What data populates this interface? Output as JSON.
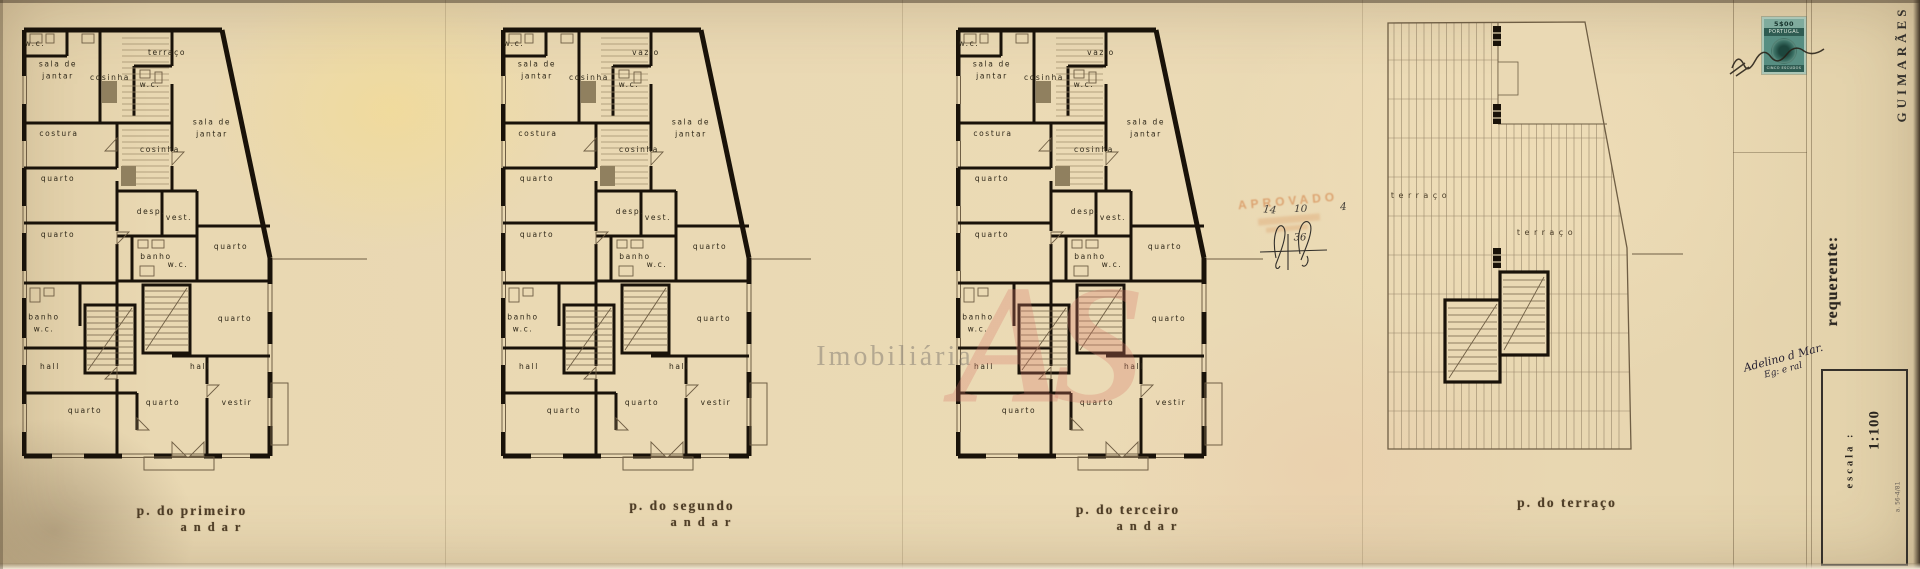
{
  "sheet": {
    "captions": {
      "first": {
        "line1": "p. do primeiro",
        "line2": "andar"
      },
      "second": {
        "line1": "p. do segundo",
        "line2": "andar"
      },
      "third": {
        "line1": "p. do terceiro",
        "line2": "andar"
      },
      "terrace": {
        "line1": "p. do terraço"
      }
    },
    "title_block": {
      "location": "GUIMARÃES",
      "requester_label": "requerente:",
      "scale_label": "escala :",
      "scale_value": "1:100",
      "form_ref": "a. 56-4/81"
    },
    "revenue_stamp": {
      "value": "5$00",
      "country": "PORTUGAL",
      "denomination": "CINCO ESCUDOS"
    },
    "annotations": {
      "approval_stamp": "APROVADO",
      "pencil_numbers": [
        "14",
        "10",
        "4"
      ],
      "pencil_circled": "36",
      "signature_line1": "Adelino d Mar.",
      "signature_line2": "Eg: e ral"
    },
    "watermarks": {
      "logo": "AS",
      "text": "Imobiliária"
    }
  },
  "plans": [
    {
      "id": "primeiro-andar",
      "rooms": [
        "w.c.",
        "sala de\njantar",
        "cosinha",
        "terraço",
        "w.c.",
        "sala de\njantar",
        "costura",
        "cosinha",
        "quarto",
        "desp.",
        "vest.",
        "quarto",
        "quarto",
        "banho",
        "w.c.",
        "quarto",
        "banho\nw.c.",
        "hall",
        "hall",
        "quarto",
        "quarto",
        "vestir"
      ]
    },
    {
      "id": "segundo-andar",
      "rooms": [
        "w.c.",
        "sala de\njantar",
        "cosinha",
        "vazio",
        "w.c.",
        "sala de\njantar",
        "costura",
        "cosinha",
        "quarto",
        "desp.",
        "vest.",
        "quarto",
        "quarto",
        "banho",
        "w.c.",
        "quarto",
        "banho\nw.c.",
        "hall",
        "hall",
        "quarto",
        "quarto",
        "vestir"
      ]
    },
    {
      "id": "terceiro-andar",
      "rooms": [
        "w.c.",
        "sala de\njantar",
        "cosinha",
        "vazio",
        "w.c.",
        "sala de\njantar",
        "costura",
        "cosinha",
        "quarto",
        "desp.",
        "vest.",
        "quarto",
        "quarto",
        "banho",
        "w.c.",
        "quarto",
        "banho\nw.c.",
        "hall",
        "hall",
        "quarto",
        "quarto",
        "vestir"
      ]
    },
    {
      "id": "terraco",
      "rooms": [
        "terraço",
        "terraço"
      ]
    }
  ]
}
